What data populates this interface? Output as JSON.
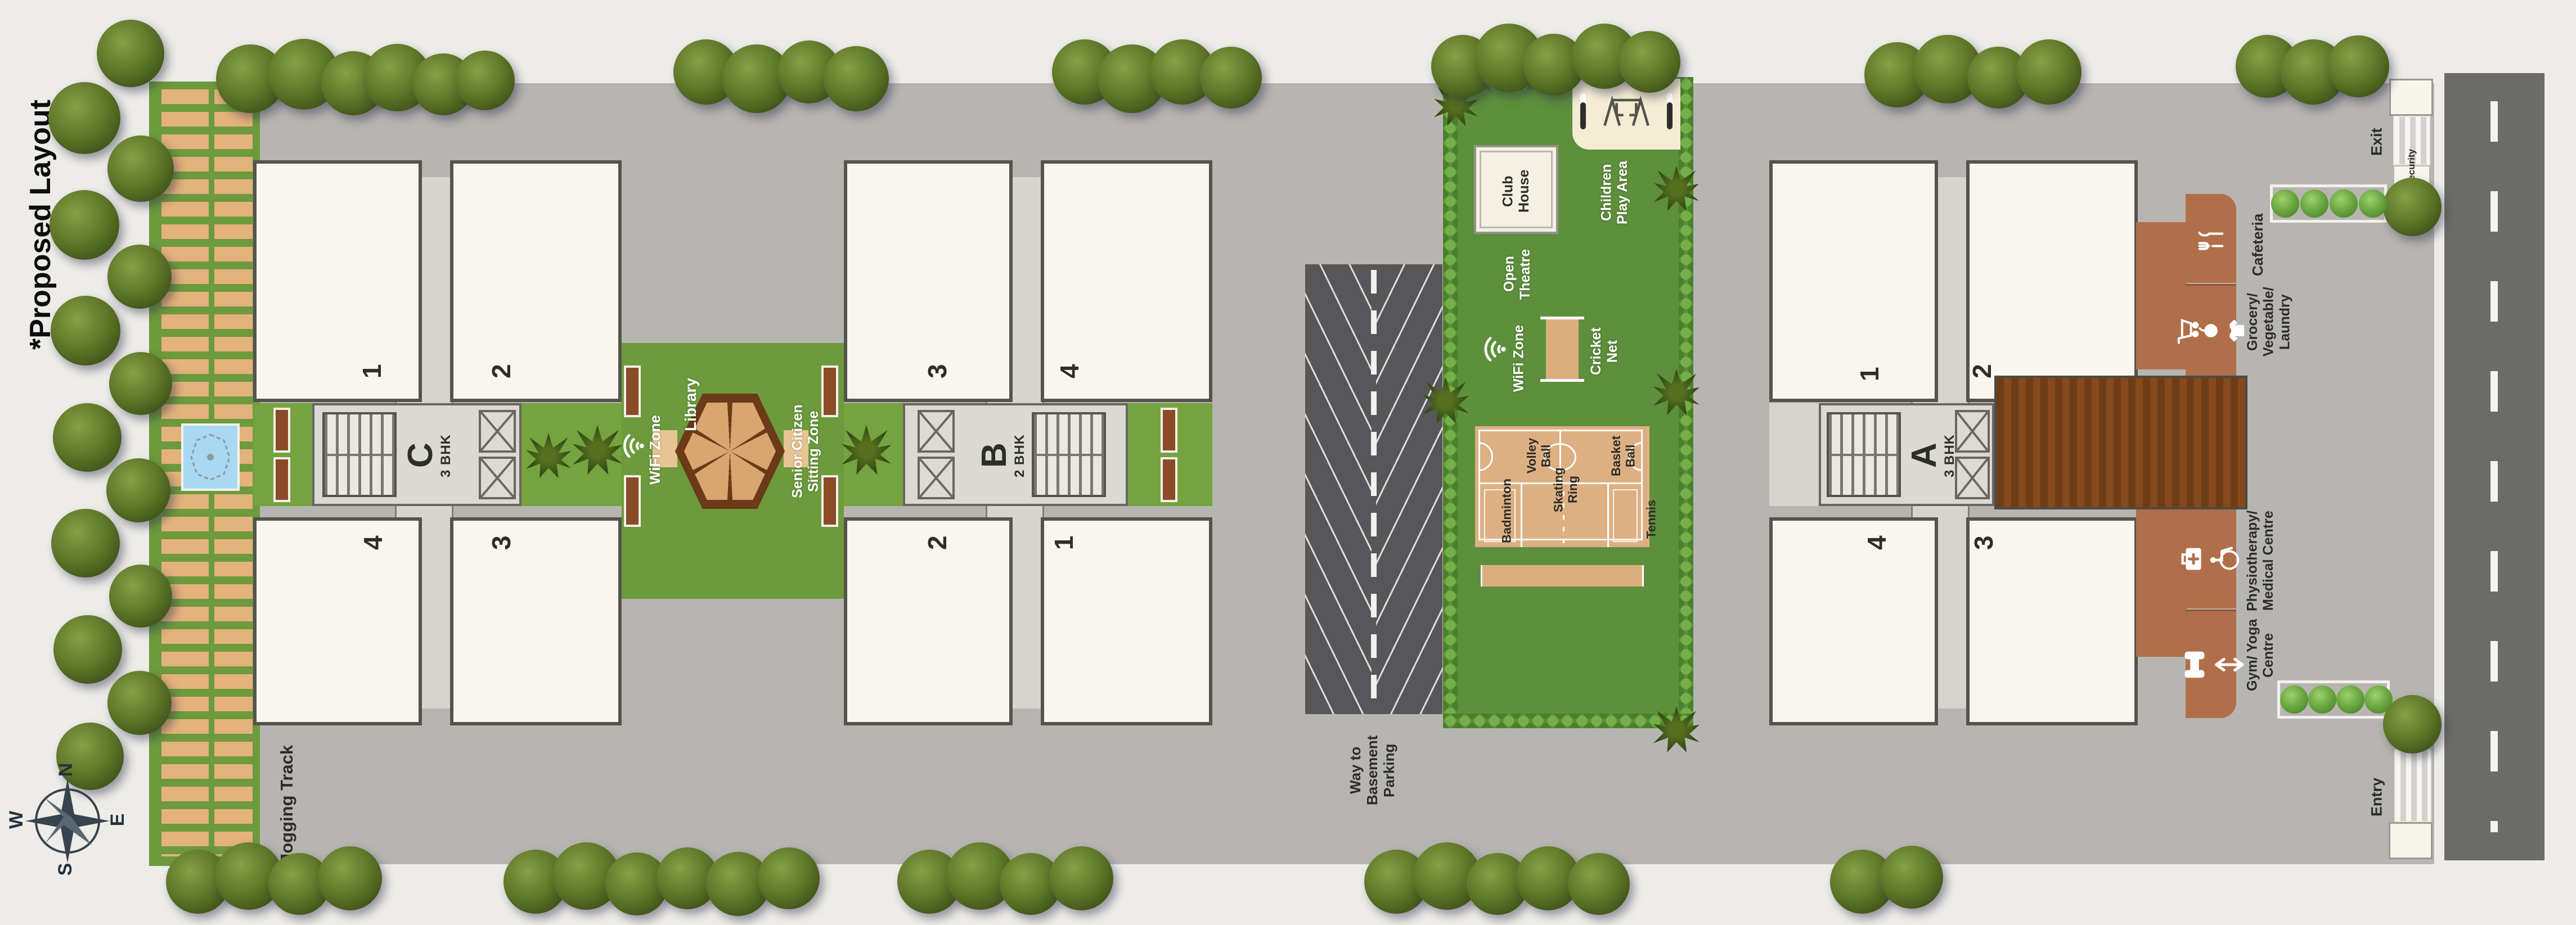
{
  "title": "*Proposed Layout",
  "compass": {
    "north": "N",
    "east": "E",
    "south": "S",
    "west": "W"
  },
  "areas": {
    "jogging_track": "Jogging Track",
    "way_to_basement_parking": "Way to Basement Parking"
  },
  "buildings": [
    {
      "name": "C",
      "type": "3 BHK",
      "units": {
        "top_left": "1",
        "top_right": "2",
        "bottom_left": "4",
        "bottom_right": "3"
      }
    },
    {
      "name": "B",
      "type": "2 BHK",
      "units": {
        "top_left": "3",
        "top_right": "4",
        "bottom_left": "2",
        "bottom_right": "1"
      }
    },
    {
      "name": "A",
      "type": "3 BHK",
      "units": {
        "top_left": "1",
        "top_right": "2",
        "bottom_left": "4",
        "bottom_right": "3"
      }
    }
  ],
  "central_garden": {
    "library": "Library",
    "wifi_zone": "WiFi Zone",
    "senior_citizen_sitting_zone": "Senior Citizen Sitting Zone"
  },
  "sports_zone": {
    "club_house": "Club House",
    "children_play_area": "Children Play Area",
    "open_theatre": "Open Theatre",
    "wifi_zone": "WiFi Zone",
    "cricket_net": "Cricket Net",
    "volley_ball": "Volley Ball",
    "basket_ball": "Basket Ball",
    "badminton": "Badminton",
    "skating_ring": "Skating Ring",
    "tennis": "Tennis"
  },
  "shops": [
    {
      "label": "Cafeteria"
    },
    {
      "label": "Grocery/ Vegetable/ Laundry"
    },
    {
      "label": "Physiotherapy/ Medical Centre"
    },
    {
      "label": "Gym/ Yoga Centre"
    }
  ],
  "gates": {
    "exit": "Exit",
    "exit_security": "Security",
    "entry": "Entry",
    "entry_security": "Security"
  },
  "colors": {
    "site_gray": "#b7b5b1",
    "lawn_green": "#6d9a3d",
    "sports_green": "#5d8f3c",
    "court_tan": "#ddb083",
    "terracotta": "#b06f4a",
    "deck_brown": "#6f3d15",
    "parking_gray": "#57575a",
    "road_gray": "#6b6b68",
    "building_white": "#f8f6ef"
  }
}
